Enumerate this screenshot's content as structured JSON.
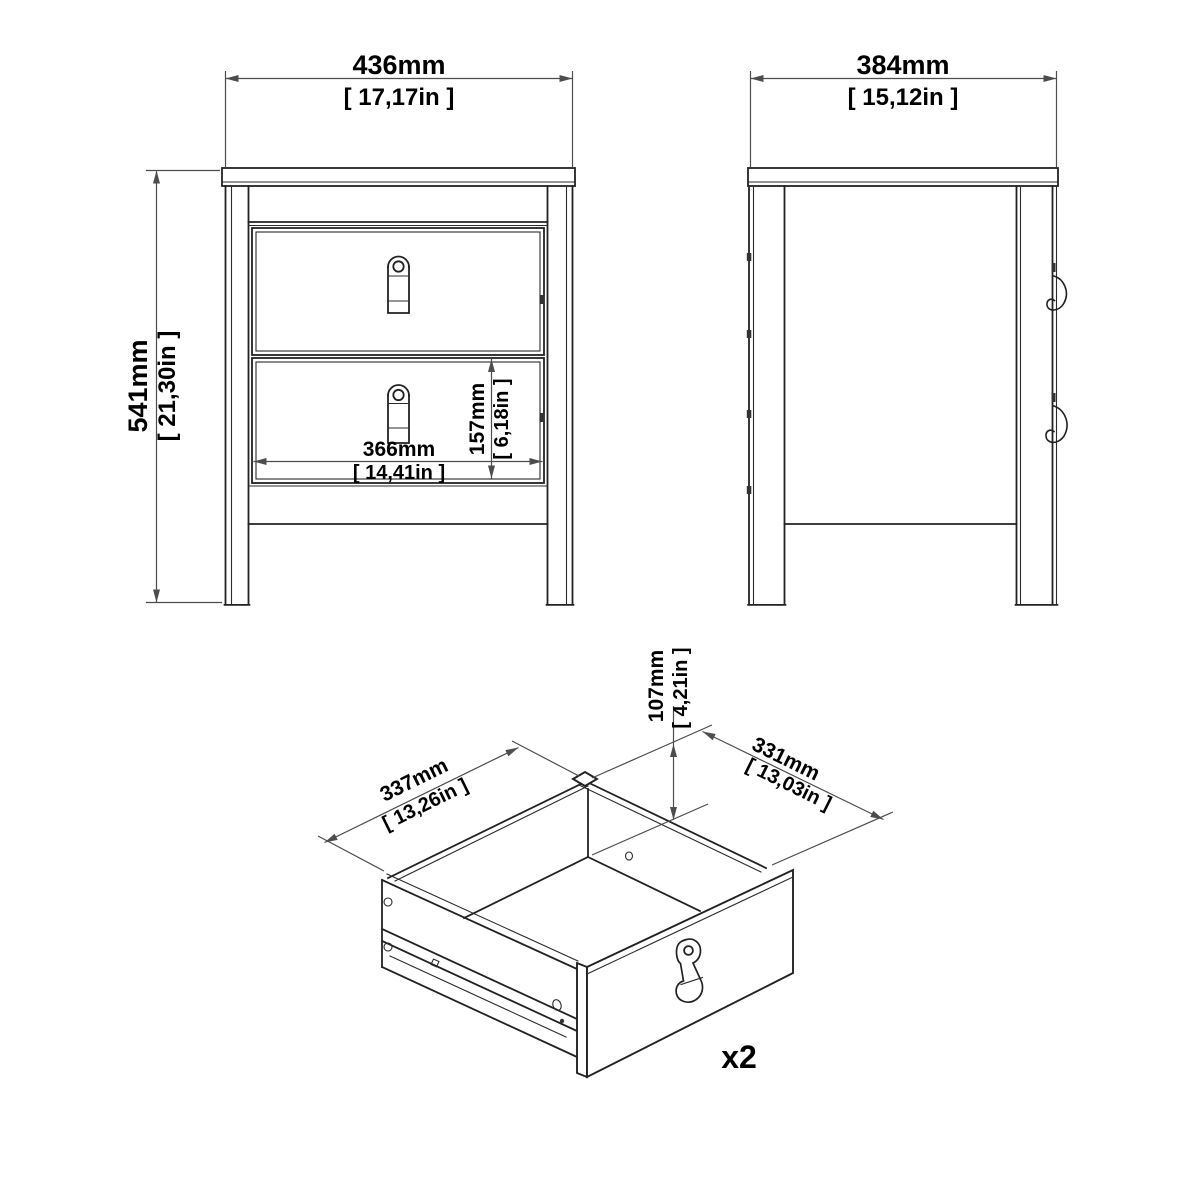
{
  "page": {
    "background": "#ffffff",
    "object_line_color": "#222222",
    "dimension_line_color": "#4d4d4d",
    "text_color": "#000000"
  },
  "front_view": {
    "width_mm": "436mm",
    "width_in": "[ 17,17in ]",
    "height_mm": "541mm",
    "height_in": "[ 21,30in ]",
    "drawer_inner_width_mm": "366mm",
    "drawer_inner_width_in": "[ 14,41in ]",
    "drawer_front_height_mm": "157mm",
    "drawer_front_height_in": "[ 6,18in ]"
  },
  "side_view": {
    "depth_mm": "384mm",
    "depth_in": "[ 15,12in ]"
  },
  "drawer_view": {
    "inner_height_mm": "107mm",
    "inner_height_in": "[ 4,21in ]",
    "back_edge_mm": "337mm",
    "back_edge_in": "[ 13,26in ]",
    "side_edge_mm": "331mm",
    "side_edge_in": "[ 13,03in ]",
    "quantity": "x2"
  }
}
